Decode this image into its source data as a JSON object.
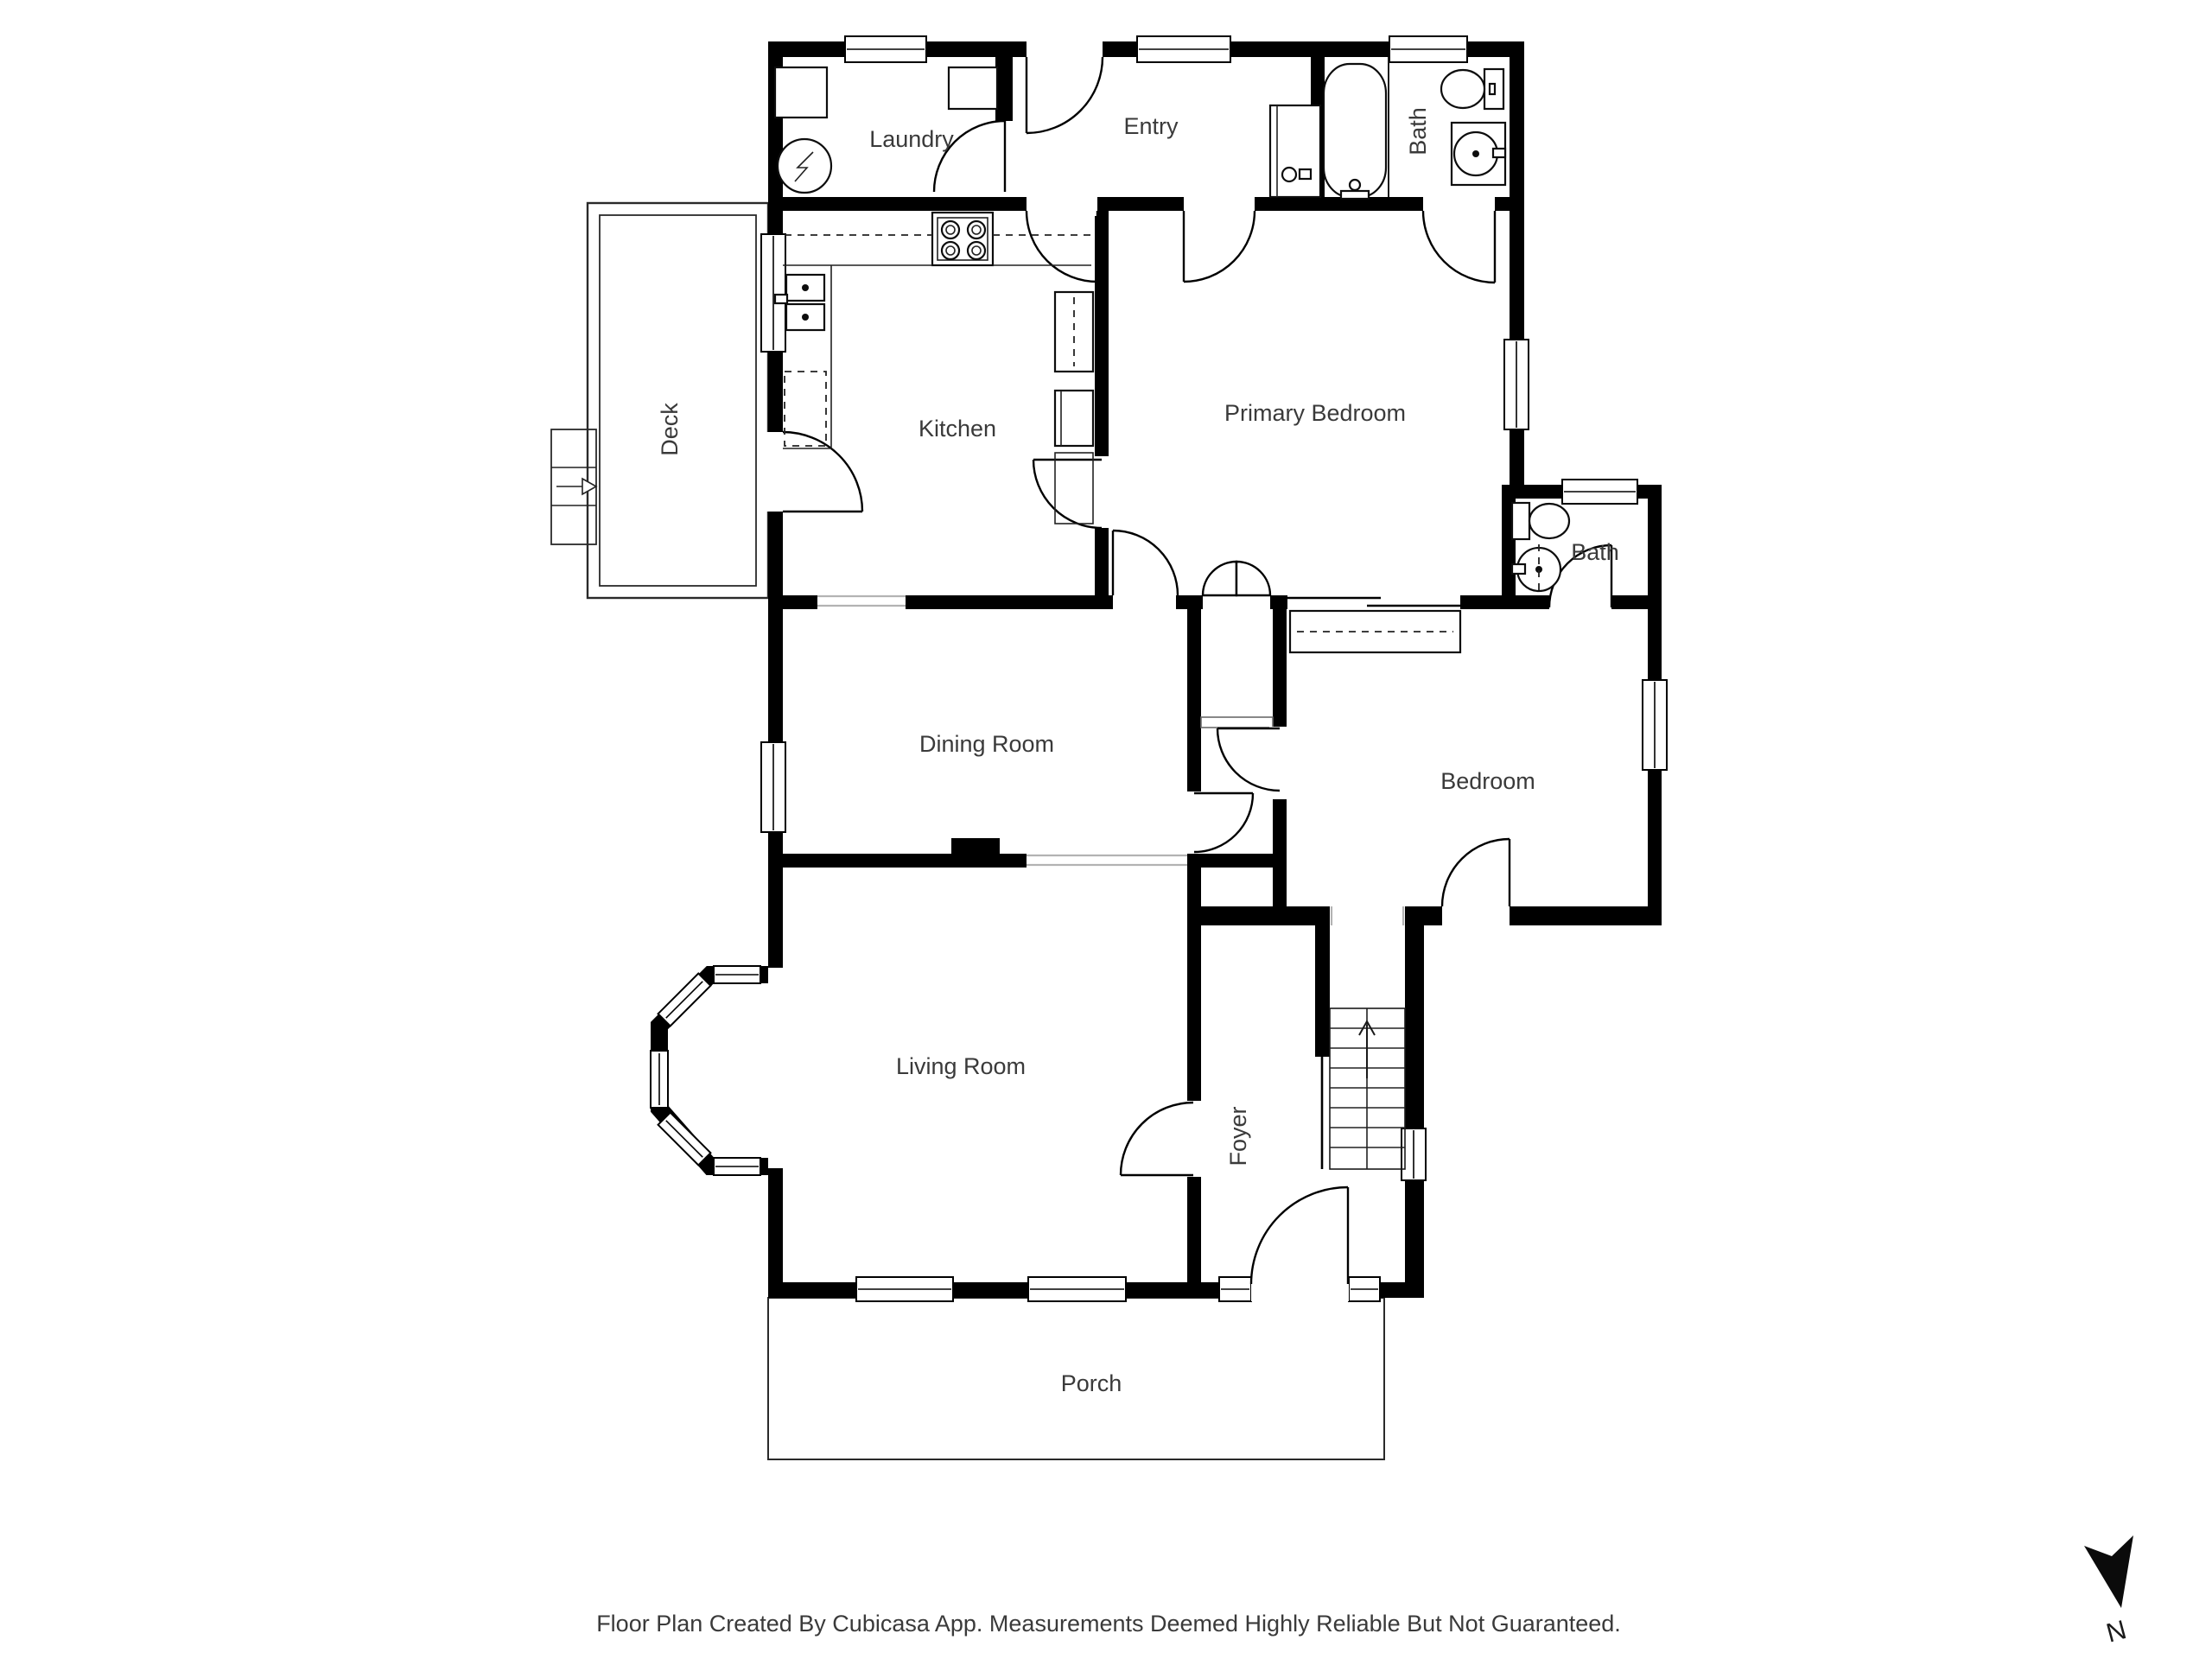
{
  "rooms": {
    "laundry": "Laundry",
    "entry": "Entry",
    "bath_top": "Bath",
    "kitchen": "Kitchen",
    "primary_bedroom": "Primary Bedroom",
    "deck": "Deck",
    "bath_mid": "Bath",
    "dining": "Dining Room",
    "bedroom": "Bedroom",
    "living": "Living Room",
    "foyer": "Foyer",
    "porch": "Porch"
  },
  "compass": {
    "label": "N"
  },
  "footer": {
    "disclaimer": "Floor Plan Created By Cubicasa App. Measurements Deemed Highly Reliable But Not Guaranteed."
  },
  "colors": {
    "wall": "#000000",
    "background": "#ffffff",
    "label": "#3a3a3a",
    "threshold": "#b3b3b3"
  }
}
